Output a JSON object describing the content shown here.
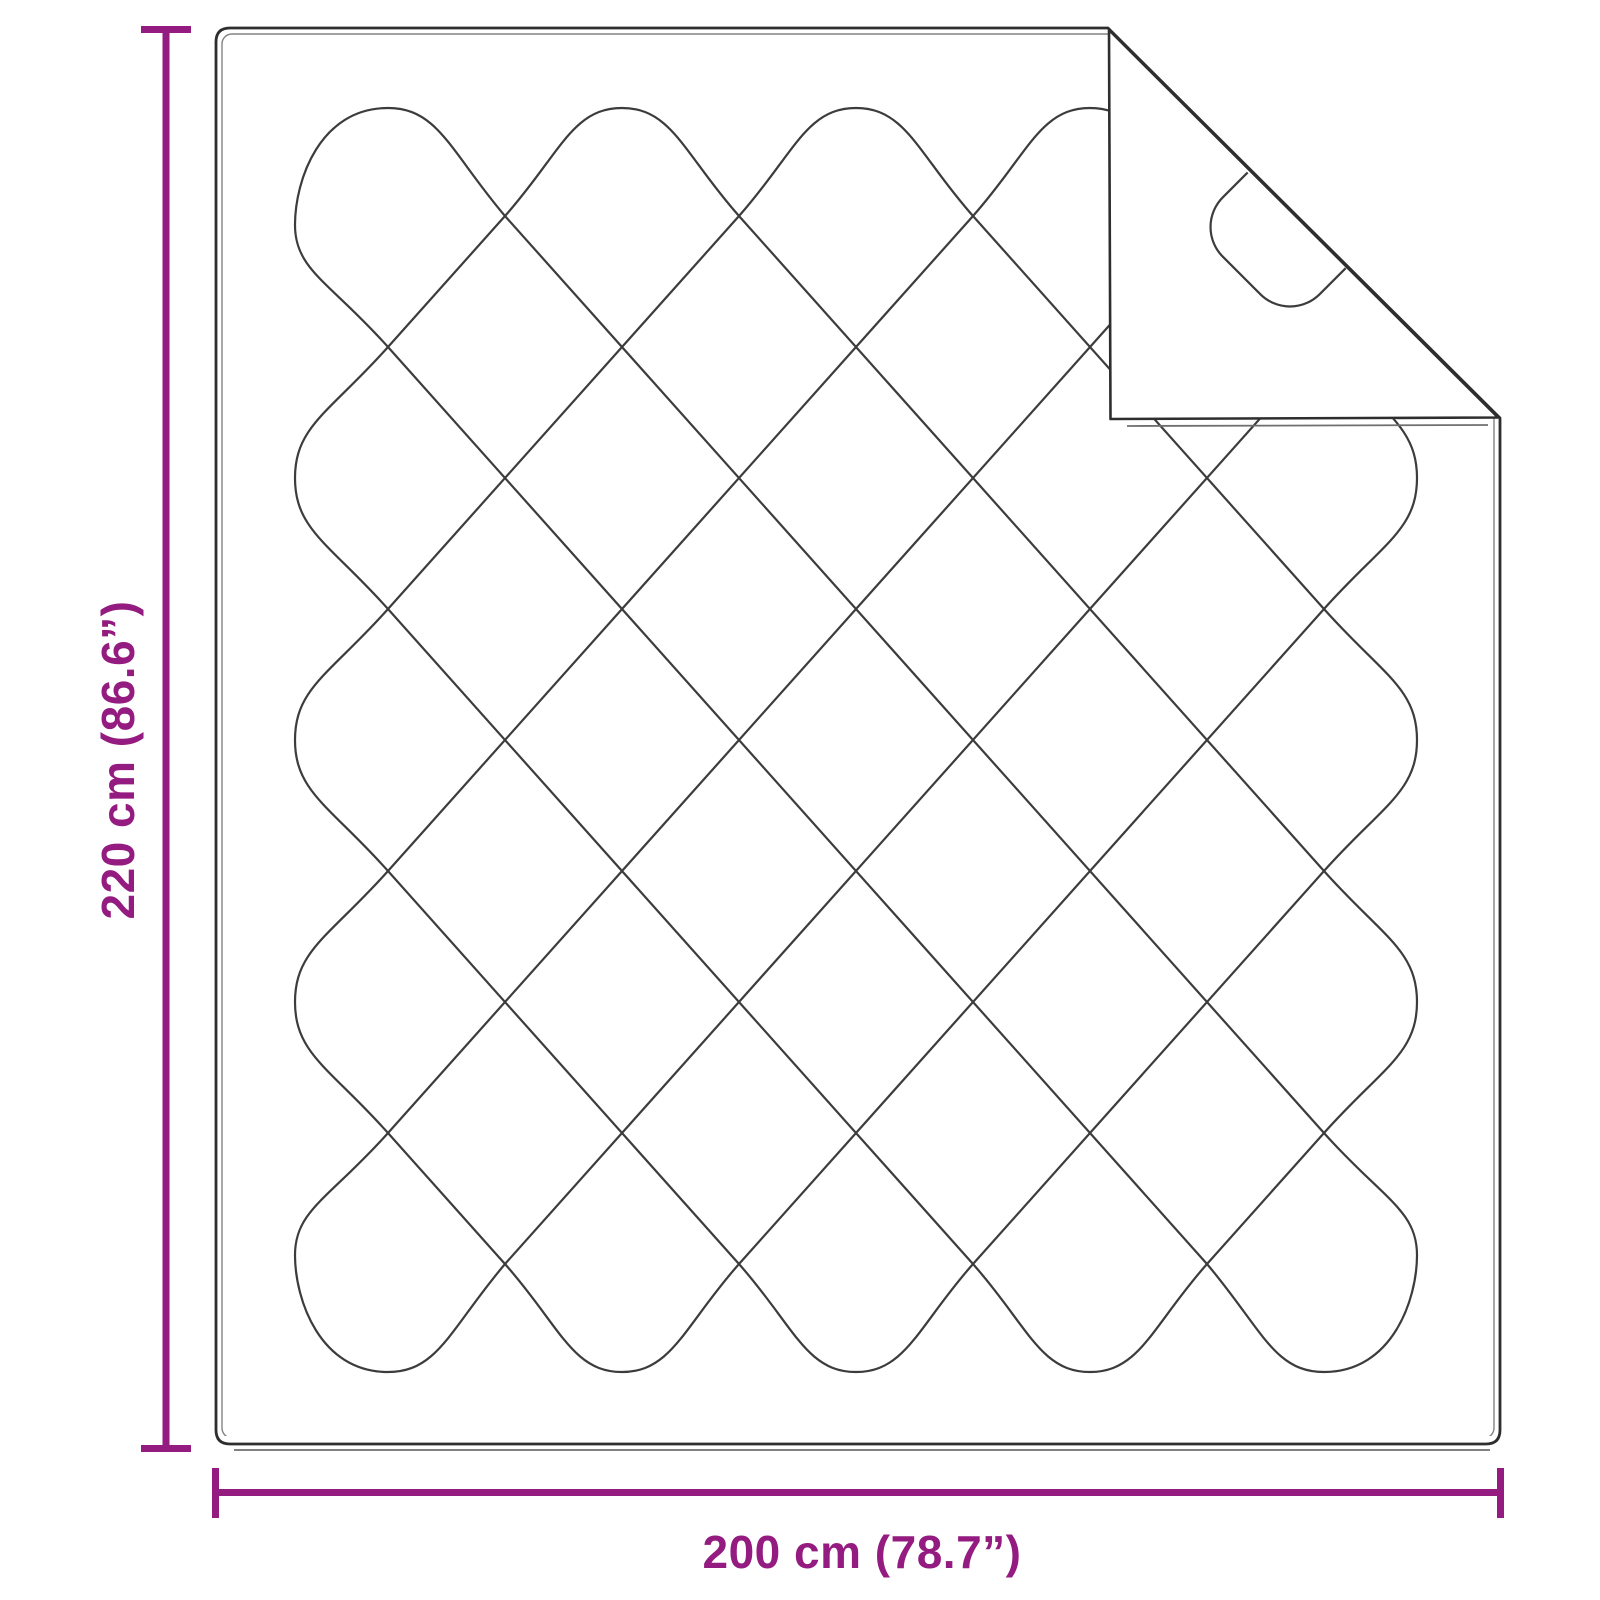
{
  "diagram": {
    "type": "product-dimension-diagram",
    "subject": "quilted blanket / duvet with folded top-right corner",
    "labels": {
      "height": "220 cm (86.6”)",
      "width": "200 cm (78.7”)"
    }
  },
  "colors": {
    "dimension": "#941b80",
    "outline": "#2e2e2e",
    "quilt": "#3c3c3c",
    "seam": "#828282",
    "shadow": "#6f6f6f",
    "background": "#ffffff"
  }
}
